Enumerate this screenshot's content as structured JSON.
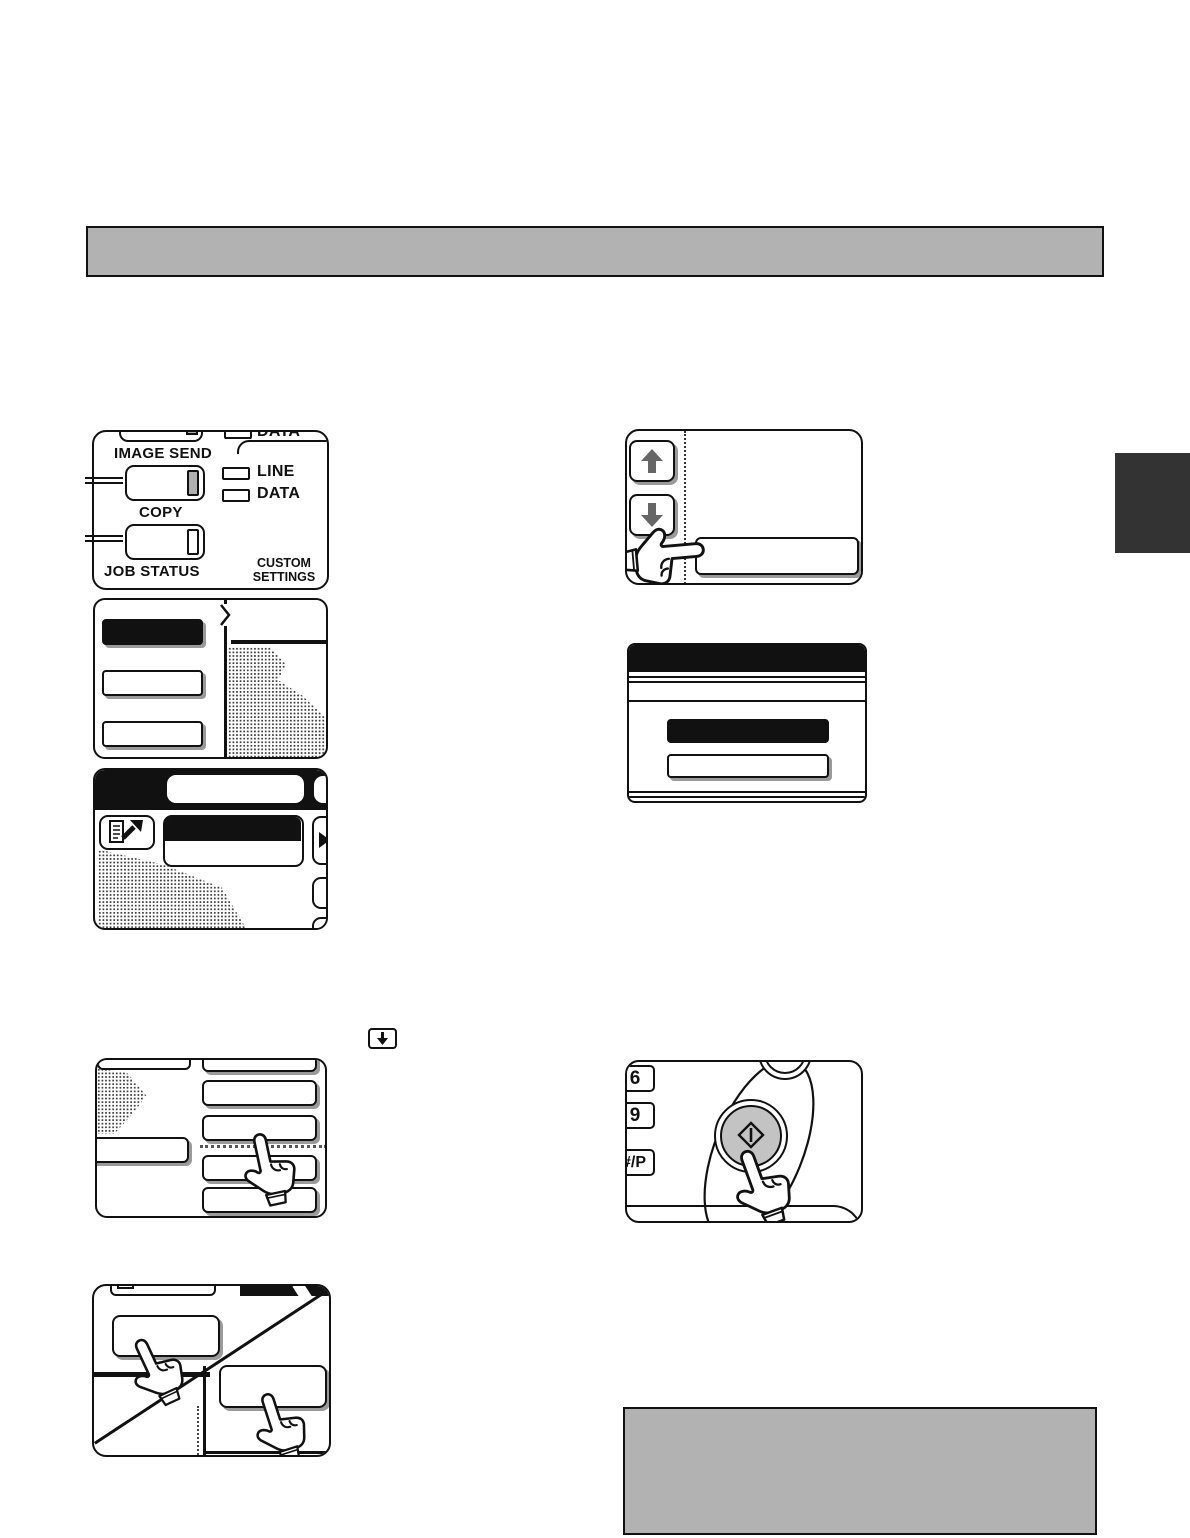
{
  "document": {
    "kind": "copier-manual-page-illustrations",
    "header_bar_text": "",
    "note_box_text": ""
  },
  "colors": {
    "ink": "#111111",
    "panel_gray": "#b2b2b2",
    "tab_dark": "#333333",
    "button_gray": "#c3c3c3",
    "indicator_gray": "#b0b0b0",
    "shadow_gray": "#9a9a9a"
  },
  "mode_panel": {
    "top_data_label": "DATA",
    "image_send_label": "IMAGE SEND",
    "line_led_label": "LINE",
    "data_led_label": "DATA",
    "copy_label": "COPY",
    "job_status_label": "JOB STATUS",
    "custom_settings_line1": "CUSTOM",
    "custom_settings_line2": "SETTINGS"
  },
  "keypad_panel": {
    "key_6": "6",
    "key_9": "9",
    "key_hash_p": "#/P"
  },
  "icons": {
    "scroll_up": "up-arrow-icon",
    "scroll_down": "down-arrow-icon",
    "inline_key": "down-arrow-key-icon",
    "start": "start-diamond-icon",
    "send_document": "document-send-icon",
    "next_arrow": "right-triangle-icon",
    "hand": "pointing-hand-icon",
    "chevron": "chevron-right-icon"
  }
}
